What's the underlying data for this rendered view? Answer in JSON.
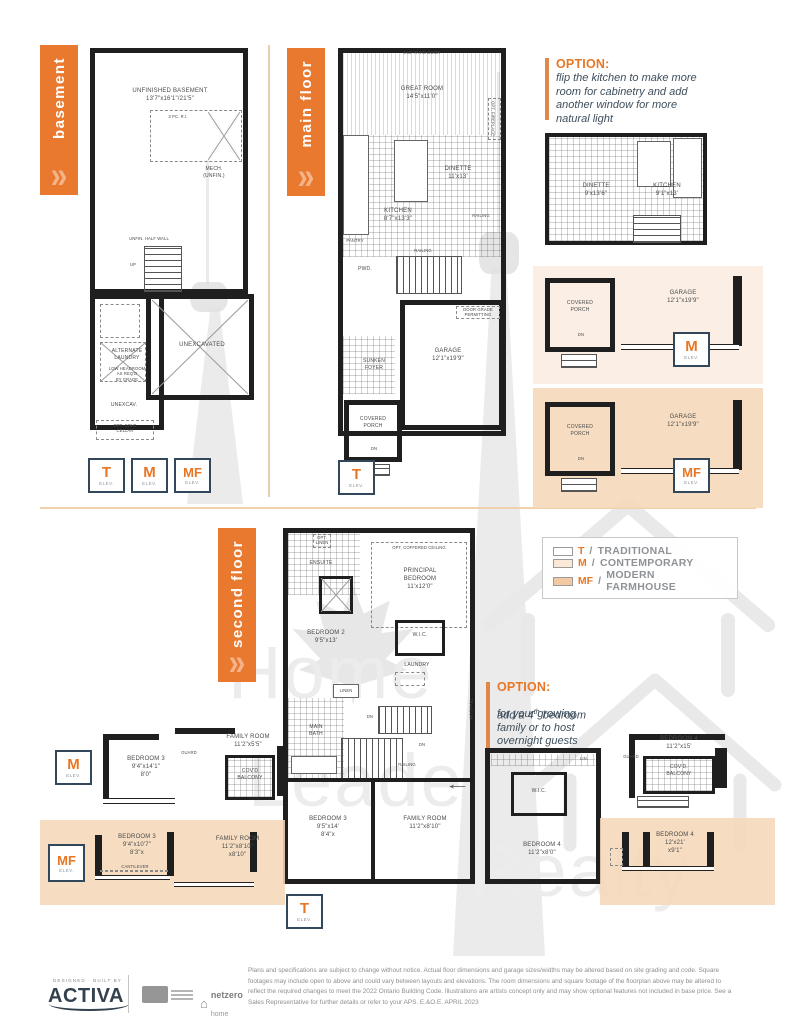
{
  "tabs": {
    "basement": "basement",
    "main_floor": "main floor",
    "second_floor": "second floor"
  },
  "icons": {
    "chevrons": "»",
    "arrow_left": "←",
    "house": "⌂"
  },
  "elev": {
    "label": "ELEV.",
    "t": "T",
    "m": "M",
    "mf": "MF"
  },
  "plans": {
    "basement": {
      "unfinished": "UNFINISHED BASEMENT\n13'7\"x16'1\"/21'5\"",
      "threepc": "3 PC. R.I.",
      "mech": "MECH.\n(UNFIN.)",
      "half_wall": "UNFIN. HALF WALL",
      "up": "UP",
      "alt_laundry": "ALTERNATE\nLAUNDRY",
      "low_headroom": "LOW HEADROOM\nAS REQ'D\nBY GRADE",
      "unexcavated": "UNEXCAVATED",
      "unexcav": "UNEXCAV.",
      "cold_cellar": "OPT. COLD\nCELLAR"
    },
    "main_floor": {
      "patio_door": "6'x8' PATIO DOOR",
      "great_room": "GREAT ROOM\n14'5\"x11'0\"",
      "opt_fireplace": "OPT. FIREPLACE",
      "dinette": "DINETTE\n11'x13'",
      "kitchen": "KITCHEN\n8'7\"x13'3\"",
      "railing": "RAILING",
      "pantry": "PANTRY",
      "pwd": "PWD.",
      "garage": "GARAGE\n12'1\"x19'9\"",
      "door_grade": "DOOR GRADE\nPERMITTING",
      "sunken_foyer": "SUNKEN\nFOYER",
      "covered_porch": "COVERED\nPORCH",
      "dn": "DN"
    },
    "kitchen_option": {
      "dinette": "DINETTE\n9'x13'6\"",
      "kitchen": "KITCHEN\n9'1\"x13'"
    },
    "garage_option": {
      "covered_porch": "COVERED\nPORCH",
      "garage": "GARAGE\n12'1\"x19'9\"",
      "dn": "DN"
    },
    "second_floor": {
      "ensuite": "ENSUITE",
      "opt_linen": "OPT.\nLINEN",
      "coffered": "OPT. COFFERED CEILING",
      "principal": "PRINCIPAL\nBEDROOM\n11'x12'0\"",
      "bedroom2": "BEDROOM 2\n9'5\"x13'",
      "wic": "W.I.C.",
      "laundry": "LAUNDRY",
      "linen": "LINEN",
      "main_bath": "MAIN\nBATH",
      "dn": "DN",
      "railing": "RAILING",
      "transom": "TRANSOM",
      "bedroom3": "BEDROOM 3\n9'5\"x14'\n8'4\"x",
      "family": "FAMILY ROOM\n11'2\"x8'10\""
    },
    "bedroom4_center": {
      "wic": "W.I.C.",
      "lin": "LIN.",
      "room": "BEDROOM 4\n11'2\"x8'0\""
    },
    "bedroom4_t": {
      "room": "BEDROOM 4\n11'2\"x15'",
      "guard": "GUARD",
      "balcony": "COV'D.\nBALCONY"
    },
    "bedroom4_mf": {
      "room": "BEDROOM 4\n12'x21'\nx9'1\""
    },
    "second_m": {
      "bedroom3": "BEDROOM 3\n9'4\"x14'1\"\n8'0\"",
      "family": "FAMILY ROOM\n11'2\"x5'5\"",
      "guard": "GUARD",
      "balcony": "COV'D\nBALCONY"
    },
    "second_mf": {
      "bedroom3": "BEDROOM 3\n9'4\"x10'7\"\n8'3\"x",
      "cantilever": "CANTILEVER",
      "family": "FAMILY ROOM\n11'2\"x8'10\"\nx8'10\""
    }
  },
  "options": {
    "kitchen": {
      "heading": "OPTION:",
      "body": "flip the kitchen to make more\nroom for cabinetry and add\nanother window for more\nnatural light"
    },
    "bedroom": {
      "heading": "OPTION:",
      "line1_pre": "add a 4",
      "line1_sup": "th",
      "line1_post": " bedroom",
      "rest": "for your growing\nfamily or to host\novernight guests"
    }
  },
  "legend": {
    "separator": "/",
    "items": [
      {
        "letter": "T",
        "name": "TRADITIONAL",
        "swatch": "#FFFFFF"
      },
      {
        "letter": "M",
        "name": "CONTEMPORARY",
        "swatch": "#FBE8D6"
      },
      {
        "letter": "MF",
        "name": "MODERN FARMHOUSE",
        "swatch": "#F3C9A3"
      }
    ]
  },
  "watermark": {
    "words": [
      "Home",
      "Leader",
      "Realty"
    ]
  },
  "footer": {
    "designed_by": "DESIGNED · BUILT BY",
    "brand": "ACTIVA",
    "netzero_top": "netzero",
    "netzero_bottom": "home",
    "disclaimer": "Plans and specifications are subject to change without notice. Actual floor dimensions and garage sizes/widths may be altered based on site grading and code. Square footages may include open to above and could vary between layouts and elevations. The room dimensions and square footage of the floorplan above may be altered to reflect the required changes to meet the 2022 Ontario Building Code. Illustrations are artists concept only and may show optional features not included in base price. See a Sales Representative for further details or refer to your APS. E.&O.E. APRIL 2023"
  },
  "colors": {
    "accent": "#E8792F",
    "badge_border": "#33475B",
    "panel_m": "#FBEEE2",
    "panel_mf": "#F5D8BB"
  }
}
